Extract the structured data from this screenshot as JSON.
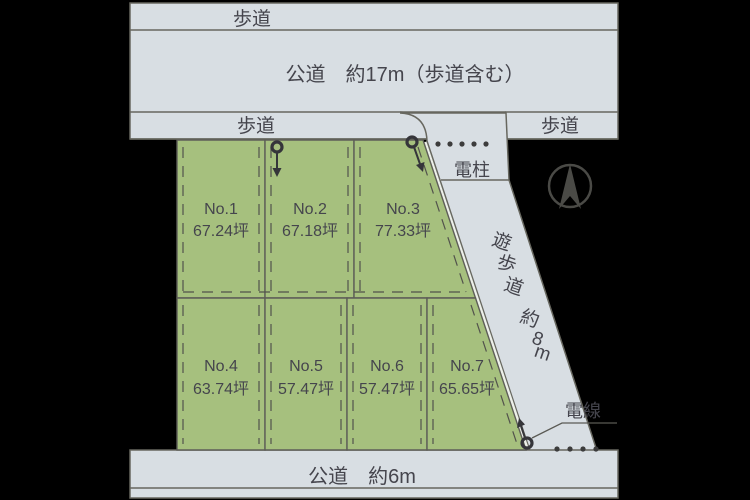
{
  "diagram_title": "land-plot-layout",
  "roads": {
    "top_sidewalk_label": "歩道",
    "top_main_label": "公道　約17m（歩道含む）",
    "mid_sidewalk_left_label": "歩道",
    "mid_sidewalk_right_label": "歩道",
    "bottom_main_label": "公道　約6m"
  },
  "promenade": {
    "label": "遊歩道 約8m",
    "chars": [
      "遊",
      "歩",
      "道",
      "約",
      "8",
      "m"
    ]
  },
  "annotations": {
    "utility_pole_label": "電柱",
    "power_line_label": "電線"
  },
  "plots": [
    {
      "no": "No.1",
      "area": "67.24坪"
    },
    {
      "no": "No.2",
      "area": "67.18坪"
    },
    {
      "no": "No.3",
      "area": "77.33坪"
    },
    {
      "no": "No.4",
      "area": "63.74坪"
    },
    {
      "no": "No.5",
      "area": "57.47坪"
    },
    {
      "no": "No.6",
      "area": "57.47坪"
    },
    {
      "no": "No.7",
      "area": "65.65坪"
    }
  ],
  "colors": {
    "background": "#000000",
    "road": "#d8dee3",
    "plot_green": "#a6c07e",
    "outline": "#67675f",
    "text": "#45454d"
  }
}
